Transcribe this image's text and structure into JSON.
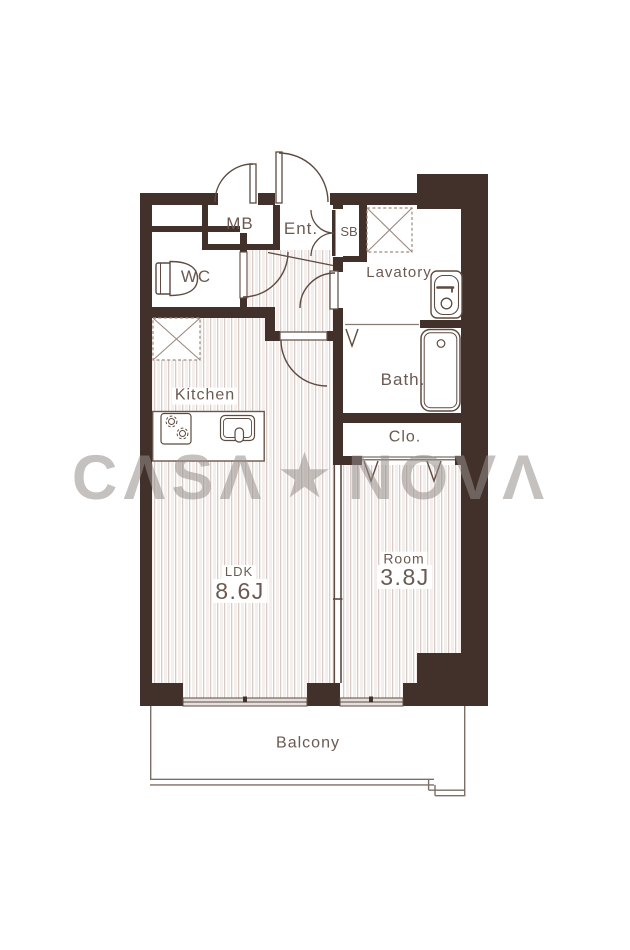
{
  "watermark": {
    "left": "CΛSΛ",
    "star": "★",
    "right": "NOVΛ"
  },
  "rooms": {
    "mb": "MB",
    "ent": "Ent.",
    "sb": "SB",
    "wc": "WC",
    "lavatory": "Lavatory",
    "kitchen": "Kitchen",
    "bath": "Bath.",
    "clo": "Clo.",
    "ldk": {
      "label": "LDK",
      "size": "8.6J"
    },
    "room": {
      "label": "Room",
      "size": "3.8J"
    },
    "balcony": "Balcony"
  },
  "icons": [
    "entrance-door-swing",
    "mb-door-swing",
    "wc-door-swing",
    "lavatory-door-swing",
    "ldk-door-swing",
    "shoebox-double-door-swing",
    "toilet-icon",
    "washbasin-icon",
    "bathtub-icon",
    "washer-space-icon",
    "fridge-space-icon",
    "stove-icon",
    "kitchen-sink-icon",
    "closet-hanger-icon",
    "bath-hanger-icon",
    "sliding-window-icon",
    "sliding-partition-icon",
    "balcony-rail"
  ],
  "colors": {
    "wall": "#42302a",
    "line": "#5d4a41",
    "floor_stripe": "#d8cac4",
    "window": "#e5e0dd",
    "watermark": "#98908c"
  }
}
